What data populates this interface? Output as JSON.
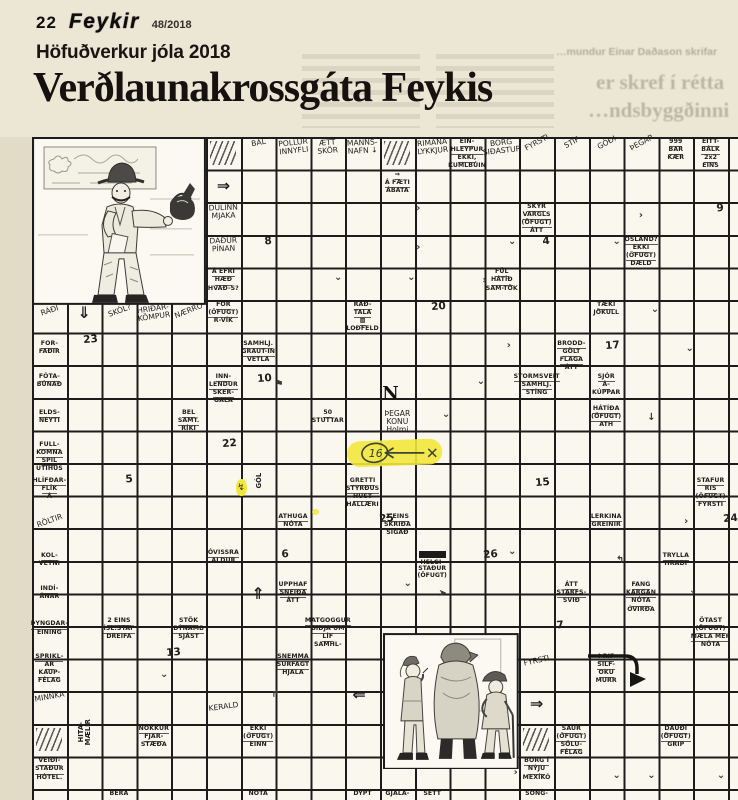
{
  "page": {
    "page_number": "22",
    "masthead": "Feykir",
    "issue": "48/2018",
    "kicker": "Höfuðverkur jóla 2018",
    "headline": "Verðlaunakrossgáta Feykis",
    "ghost": [
      "…mundur Einar Daðason skrifar",
      "er skref í rétta",
      "…ndsbyggðinni"
    ]
  },
  "colors": {
    "page_bg": "#e2dbc6",
    "header_bg": "#ece6d5",
    "paper": "#faf7ef",
    "grid_line": "#1c1c1c",
    "highlighter": "#f2e73c"
  },
  "grid": {
    "origin_x": 32,
    "origin_y": 137,
    "cell_w": 34.8,
    "cell_h": 32.6,
    "cols": 20,
    "rows": 20,
    "highlight": {
      "r": 10.2,
      "c": 10.0,
      "w": 2.85,
      "h": 1.0,
      "label": "16"
    },
    "illustrations": [
      {
        "id": "illus-man",
        "name": "man-with-kettle-drawing",
        "r": 1,
        "c": 1,
        "w": 5.0,
        "h": 5.15
      },
      {
        "id": "illus-figures",
        "name": "three-figures-drawing",
        "r": 16.2,
        "c": 11.1,
        "w": 3.9,
        "h": 4.2
      }
    ],
    "cells": [
      {
        "r": 1,
        "c": 6,
        "k": "hatch"
      },
      {
        "r": 1,
        "c": 7,
        "k": "script",
        "t": [
          "BÁL"
        ],
        "rot": -10
      },
      {
        "r": 1,
        "c": 8,
        "k": "script",
        "t": [
          "POLLUR",
          "INNYFLI"
        ],
        "rot": -6
      },
      {
        "r": 1,
        "c": 9,
        "k": "script",
        "t": [
          "ÆTT",
          "SKÖR"
        ],
        "rot": -4
      },
      {
        "r": 1,
        "c": 10,
        "k": "script",
        "t": [
          "MANNS-",
          "NAFN ↓"
        ],
        "rot": -3
      },
      {
        "r": 1,
        "c": 11,
        "k": "hatch"
      },
      {
        "r": 1,
        "c": 12,
        "k": "script",
        "t": [
          "RIMANA",
          "LYKKJUR"
        ],
        "rot": -5
      },
      {
        "r": 1,
        "c": 13,
        "k": "clue",
        "t": [
          "EIN-",
          "HLEYPUR",
          "EKKI,",
          "KUMLBÚIN"
        ]
      },
      {
        "r": 1,
        "c": 14,
        "k": "script",
        "t": [
          "BORG",
          "SIÐASTUR"
        ],
        "rot": -6
      },
      {
        "r": 1,
        "c": 15,
        "k": "script",
        "t": [
          "FYRSTI"
        ],
        "rot": -28
      },
      {
        "r": 1,
        "c": 16,
        "k": "script",
        "t": [
          "STÍF"
        ],
        "rot": -28
      },
      {
        "r": 1,
        "c": 17,
        "k": "script",
        "t": [
          "GÓÐI"
        ],
        "rot": -28
      },
      {
        "r": 1,
        "c": 18,
        "k": "script",
        "t": [
          "ÞEGAR"
        ],
        "rot": -28
      },
      {
        "r": 1,
        "c": 19,
        "k": "clue",
        "t": [
          "999",
          "BAR",
          "KÆR"
        ]
      },
      {
        "r": 1,
        "c": 20,
        "k": "clue",
        "t": [
          "EITT-",
          "BÁLK",
          "2x2",
          "EINS"
        ]
      },
      {
        "r": 2.2,
        "c": 6,
        "k": "bigarrow",
        "t": [
          "⇒"
        ]
      },
      {
        "r": 2,
        "c": 11,
        "k": "clue",
        "t": [
          "⇒",
          "Á FÆTI",
          "ÁBATA"
        ]
      },
      {
        "r": 3,
        "c": 6,
        "k": "script",
        "t": [
          "DULINN",
          "MJAKA"
        ],
        "rot": -2
      },
      {
        "r": 3,
        "c": 15,
        "k": "clue",
        "t": [
          "SKYR",
          "VARGLS",
          "(ÖFUGT)",
          "ÁTT"
        ]
      },
      {
        "r": 3,
        "c": 20,
        "k": "num",
        "t": [
          "9"
        ]
      },
      {
        "r": 4,
        "c": 6,
        "k": "script",
        "t": [
          "DAÐUR",
          "PÍNAN"
        ],
        "rot": -2
      },
      {
        "r": 4,
        "c": 7,
        "k": "num",
        "t": [
          "8"
        ]
      },
      {
        "r": 4,
        "c": 15,
        "k": "num",
        "t": [
          "4"
        ]
      },
      {
        "r": 4,
        "c": 18,
        "k": "clue",
        "t": [
          "ÓSLAND?",
          "EKKI",
          "(ÖFUGT)",
          "DÆLD"
        ]
      },
      {
        "r": 5,
        "c": 6,
        "k": "clue",
        "t": [
          "Á EFRI",
          "HÆÐ",
          "HVAÐ-S?"
        ]
      },
      {
        "r": 5,
        "c": 14,
        "k": "clue",
        "t": [
          "FÚL",
          "HÁTÍÐ",
          "SAM-TÖK"
        ]
      },
      {
        "r": 6.15,
        "c": 1,
        "k": "script",
        "t": [
          "RÁÐI"
        ],
        "rot": -18
      },
      {
        "r": 6.1,
        "c": 2,
        "k": "bigarrow",
        "t": [
          "⇓"
        ]
      },
      {
        "r": 6.15,
        "c": 3,
        "k": "script",
        "t": [
          "SKÓL?"
        ],
        "rot": -20
      },
      {
        "r": 6.1,
        "c": 4,
        "k": "script",
        "t": [
          "HRIÐAR-",
          "KÖMPUR"
        ],
        "rot": -8
      },
      {
        "r": 6.15,
        "c": 5,
        "k": "script",
        "t": [
          "NÆRRÓ"
        ],
        "rot": -22
      },
      {
        "r": 6,
        "c": 6,
        "k": "clue",
        "t": [
          "FOR",
          "(ÖFUGT)",
          "R-VÍK"
        ]
      },
      {
        "r": 6,
        "c": 10,
        "k": "clue",
        "t": [
          "RAÐ-",
          "TALA",
          "▩",
          "LOÐFELD"
        ]
      },
      {
        "r": 6,
        "c": 12,
        "k": "num",
        "t": [
          "20"
        ]
      },
      {
        "r": 6,
        "c": 17,
        "k": "clue",
        "t": [
          "TÆKI",
          "JÖKULL"
        ]
      },
      {
        "r": 7.2,
        "c": 1,
        "k": "clue",
        "t": [
          "FOR-",
          "FAÐIR"
        ]
      },
      {
        "r": 7,
        "c": 2,
        "k": "num",
        "t": [
          "23"
        ]
      },
      {
        "r": 7.2,
        "c": 7,
        "k": "clue",
        "t": [
          "SAMHLJ.",
          "GRAUT-IN",
          "VETLA"
        ]
      },
      {
        "r": 7.2,
        "c": 16,
        "k": "clue",
        "t": [
          "BRODD-",
          "GÖLT",
          "FLAGA",
          "ÁTT"
        ]
      },
      {
        "r": 7.2,
        "c": 17,
        "k": "num",
        "t": [
          "17"
        ]
      },
      {
        "r": 8.2,
        "c": 1,
        "k": "clue",
        "t": [
          "FÓTA-",
          "BÚNAÐ"
        ]
      },
      {
        "r": 8.2,
        "c": 6,
        "k": "clue",
        "t": [
          "INN-",
          "LENDUR",
          "SKER-",
          "GALA"
        ]
      },
      {
        "r": 8.2,
        "c": 7,
        "k": "num",
        "t": [
          "10"
        ]
      },
      {
        "r": 8.5,
        "c": 10.8,
        "k": "bigletter",
        "t": [
          "N"
        ]
      },
      {
        "r": 8.2,
        "c": 15,
        "k": "clue",
        "t": [
          "STORMSVEIT",
          "SAMHLJ.",
          "STÍNG"
        ]
      },
      {
        "r": 8.2,
        "c": 17,
        "k": "clue",
        "t": [
          "SJÓR",
          "Á-",
          "KÚPPAR"
        ]
      },
      {
        "r": 9.3,
        "c": 1,
        "k": "clue",
        "t": [
          "ELDS-",
          "NEYTI"
        ]
      },
      {
        "r": 9.3,
        "c": 5,
        "k": "clue",
        "t": [
          "BEL",
          "SAMT.",
          "RÍKI"
        ]
      },
      {
        "r": 9.3,
        "c": 9,
        "k": "clue",
        "t": [
          "50",
          "STUTTAR"
        ]
      },
      {
        "r": 9.3,
        "c": 11,
        "k": "script",
        "t": [
          "ÞEGAR",
          "KONU",
          "Holmi"
        ]
      },
      {
        "r": 9.2,
        "c": 17,
        "k": "clue",
        "t": [
          "HÁTÍÐA",
          "(ÖFUGT)",
          "ATH"
        ]
      },
      {
        "r": 10.3,
        "c": 1,
        "k": "clue",
        "t": [
          "FULL-",
          "KOMNA",
          "SPIL",
          "ÚTIHÚS"
        ]
      },
      {
        "r": 10.2,
        "c": 6,
        "k": "num",
        "t": [
          "22"
        ]
      },
      {
        "r": 11.4,
        "c": 1,
        "k": "clue",
        "t": [
          "HLÍFÐAR-",
          "FLÍK",
          "Á"
        ]
      },
      {
        "r": 11.3,
        "c": 3,
        "k": "num",
        "t": [
          "5"
        ]
      },
      {
        "r": 11.5,
        "c": 6.85,
        "k": "flame",
        "t": [
          "↯"
        ]
      },
      {
        "r": 11.4,
        "c": 7,
        "k": "vert",
        "t": [
          "GÓL"
        ]
      },
      {
        "r": 11.4,
        "c": 10,
        "k": "clue",
        "t": [
          "GRETTI",
          "STYRÐUS",
          "HUST",
          "HALLÆRI"
        ]
      },
      {
        "r": 11.4,
        "c": 15,
        "k": "num",
        "t": [
          "15"
        ]
      },
      {
        "r": 11.4,
        "c": 20,
        "k": "clue",
        "t": [
          "STAFUR",
          "RIS",
          "(ÖFUGT)",
          "FYRSTI"
        ]
      },
      {
        "r": 12.6,
        "c": 1,
        "k": "script",
        "t": [
          "RÖLTIR"
        ],
        "rot": -20
      },
      {
        "r": 12.5,
        "c": 8,
        "k": "clue",
        "t": [
          "ATHUGA",
          "NÓTA"
        ]
      },
      {
        "r": 12.4,
        "c": 9.05,
        "k": "dot"
      },
      {
        "r": 12.5,
        "c": 10.5,
        "k": "num",
        "t": [
          "25"
        ]
      },
      {
        "r": 12.5,
        "c": 11,
        "k": "clue",
        "t": [
          "2 EINS",
          "SKRIÐA",
          "SIGAÐ"
        ]
      },
      {
        "r": 12.5,
        "c": 17,
        "k": "clue",
        "t": [
          "LERKINA",
          "GREINIR"
        ]
      },
      {
        "r": 12.5,
        "c": 20.4,
        "k": "num",
        "t": [
          "24"
        ]
      },
      {
        "r": 13.7,
        "c": 1,
        "k": "clue",
        "t": [
          "KOL-",
          "VETNI"
        ]
      },
      {
        "r": 13.6,
        "c": 6,
        "k": "clue",
        "t": [
          "ÓVISSRA",
          "ALDUR"
        ]
      },
      {
        "r": 13.6,
        "c": 7.5,
        "k": "num",
        "t": [
          "6"
        ]
      },
      {
        "r": 13.6,
        "c": 12,
        "k": "redacted",
        "t": [
          "HELGI-",
          "STAÐUR",
          "(ÖFUGT)"
        ]
      },
      {
        "r": 13.6,
        "c": 13.5,
        "k": "num",
        "t": [
          "26"
        ]
      },
      {
        "r": 13.7,
        "c": 19,
        "k": "clue",
        "t": [
          "TRYLLA",
          "HRAÐI"
        ]
      },
      {
        "r": 14.7,
        "c": 1,
        "k": "clue",
        "t": [
          "INDÍ-",
          "ÁNAR"
        ]
      },
      {
        "r": 14.7,
        "c": 7,
        "k": "bigarrow",
        "t": [
          "⇑"
        ]
      },
      {
        "r": 14.6,
        "c": 8,
        "k": "clue",
        "t": [
          "UPPHAF",
          "SNEIÐA",
          "ÁTT"
        ]
      },
      {
        "r": 14.6,
        "c": 16,
        "k": "clue",
        "t": [
          "ÁTT",
          "STARFS-",
          "SVIÐ"
        ]
      },
      {
        "r": 14.6,
        "c": 18,
        "k": "clue",
        "t": [
          "FANG",
          "KARGAN",
          "NÓTA",
          "ÓVIRÐA"
        ]
      },
      {
        "r": 15.8,
        "c": 1,
        "k": "clue",
        "t": [
          "ÞYNGDAR-",
          "EINING"
        ]
      },
      {
        "r": 15.7,
        "c": 3,
        "k": "clue",
        "t": [
          "2 EINS",
          "ÍSL.STAF",
          "DREIFA"
        ]
      },
      {
        "r": 15.7,
        "c": 5,
        "k": "clue",
        "t": [
          "STÖK",
          "DÝNAMB",
          "SJÁST"
        ]
      },
      {
        "r": 15.7,
        "c": 9,
        "k": "clue",
        "t": [
          "MATGOGGUR",
          "BIÐJA UM",
          "LÍF",
          "SAMHL-"
        ]
      },
      {
        "r": 15.8,
        "c": 15.4,
        "k": "num",
        "t": [
          "7"
        ]
      },
      {
        "r": 15.7,
        "c": 20,
        "k": "clue",
        "t": [
          "ÖTAST",
          "(ÖFUGT)",
          "MÆLA MER",
          "NÓTA"
        ]
      },
      {
        "r": 16.8,
        "c": 1,
        "k": "clue",
        "t": [
          "SPRIKL-",
          "AR",
          "KAUP-",
          "FÉLAG"
        ]
      },
      {
        "r": 16.6,
        "c": 4.4,
        "k": "num",
        "t": [
          "13"
        ]
      },
      {
        "r": 16.8,
        "c": 8,
        "k": "clue",
        "t": [
          "SNEMMA",
          "SURFAGT",
          "HJALA"
        ]
      },
      {
        "r": 16.9,
        "c": 15,
        "k": "script",
        "t": [
          "FYRSTI"
        ],
        "rot": -12
      },
      {
        "r": 16.8,
        "c": 17,
        "k": "clue",
        "t": [
          "ÞRIF",
          "SILF-",
          "OKU",
          "MURR"
        ]
      },
      {
        "r": 18,
        "c": 1,
        "k": "script",
        "t": [
          "MINNKA"
        ],
        "rot": -10
      },
      {
        "r": 17.8,
        "c": 9.9,
        "k": "bigarrow",
        "t": [
          "⇐"
        ]
      },
      {
        "r": 18.1,
        "c": 15,
        "k": "bigarrow",
        "t": [
          "⇒"
        ]
      },
      {
        "r": 18.3,
        "c": 6,
        "k": "script",
        "t": [
          "KERALD"
        ],
        "rot": -8
      },
      {
        "r": 19,
        "c": 1,
        "k": "hatch"
      },
      {
        "r": 19,
        "c": 2,
        "k": "vert",
        "t": [
          "HITA-",
          "MÆLIR"
        ]
      },
      {
        "r": 19,
        "c": 4,
        "k": "clue",
        "t": [
          "NOKKUR",
          "FJAR-",
          "STÆÐA"
        ]
      },
      {
        "r": 19,
        "c": 7,
        "k": "clue",
        "t": [
          "EKKI",
          "(ÖFUGT)",
          "EINN"
        ]
      },
      {
        "r": 19,
        "c": 15,
        "k": "hatch"
      },
      {
        "r": 19,
        "c": 16,
        "k": "clue",
        "t": [
          "SAUR",
          "(ÖFUGT)",
          "SÖLU-",
          "FÉLAG"
        ]
      },
      {
        "r": 19,
        "c": 19,
        "k": "clue",
        "t": [
          "DAUÐI",
          "(ÖFUGT)",
          "GRIP"
        ]
      },
      {
        "r": 20,
        "c": 1,
        "k": "clue",
        "t": [
          "VEIÐI-",
          "STAÐUR",
          "HÓTEL."
        ]
      },
      {
        "r": 20,
        "c": 15,
        "k": "clue",
        "t": [
          "BORG Í",
          "NÝJU",
          "MEXÍKÓ"
        ]
      },
      {
        "r": 21,
        "c": 3,
        "k": "clue",
        "t": [
          "BERA"
        ]
      },
      {
        "r": 21,
        "c": 7,
        "k": "clue",
        "t": [
          "NÓTA"
        ]
      },
      {
        "r": 21,
        "c": 10,
        "k": "clue",
        "t": [
          "DÝPT"
        ]
      },
      {
        "r": 21,
        "c": 11,
        "k": "clue",
        "t": [
          "GJALA-"
        ]
      },
      {
        "r": 21,
        "c": 12,
        "k": "clue",
        "t": [
          "SETT"
        ]
      },
      {
        "r": 21,
        "c": 15,
        "k": "clue",
        "t": [
          "SÖNG-"
        ]
      },
      {
        "r": 3,
        "c": 11.6,
        "k": "mark",
        "t": [
          "›"
        ]
      },
      {
        "r": 3.2,
        "c": 18,
        "k": "mark",
        "t": [
          "›"
        ]
      },
      {
        "r": 4.2,
        "c": 11.6,
        "k": "mark",
        "t": [
          "›"
        ]
      },
      {
        "r": 4,
        "c": 14.3,
        "k": "mark",
        "t": [
          "⌄"
        ]
      },
      {
        "r": 4,
        "c": 17.3,
        "k": "mark",
        "t": [
          "⌄"
        ]
      },
      {
        "r": 5.1,
        "c": 9.3,
        "k": "mark",
        "t": [
          "⌄"
        ]
      },
      {
        "r": 5.1,
        "c": 11.4,
        "k": "mark",
        "t": [
          "⌄"
        ]
      },
      {
        "r": 5.2,
        "c": 13.5,
        "k": "mark",
        "t": [
          "›"
        ]
      },
      {
        "r": 6.1,
        "c": 18.4,
        "k": "mark",
        "t": [
          "⌄"
        ]
      },
      {
        "r": 7.2,
        "c": 14.2,
        "k": "mark",
        "t": [
          "›"
        ]
      },
      {
        "r": 7.3,
        "c": 19.4,
        "k": "mark",
        "t": [
          "⌄"
        ]
      },
      {
        "r": 8.3,
        "c": 13.4,
        "k": "mark",
        "t": [
          "⌄"
        ]
      },
      {
        "r": 8.4,
        "c": 7.6,
        "k": "mark",
        "t": [
          "⚑"
        ]
      },
      {
        "r": 9.3,
        "c": 12.4,
        "k": "mark",
        "t": [
          "⌄"
        ]
      },
      {
        "r": 9.4,
        "c": 18.3,
        "k": "mark",
        "t": [
          "↓"
        ]
      },
      {
        "r": 12.6,
        "c": 19.3,
        "k": "mark",
        "t": [
          "›"
        ]
      },
      {
        "r": 13.5,
        "c": 14.3,
        "k": "mark",
        "t": [
          "⌄"
        ]
      },
      {
        "r": 13.8,
        "c": 17.4,
        "k": "mark",
        "t": [
          "↰"
        ]
      },
      {
        "r": 14.8,
        "c": 12.3,
        "k": "mark",
        "t": [
          "➤"
        ]
      },
      {
        "r": 14.5,
        "c": 11.3,
        "k": "mark",
        "t": [
          "⌄"
        ]
      },
      {
        "r": 14.7,
        "c": 19.5,
        "k": "mark",
        "t": [
          "⌄"
        ]
      },
      {
        "r": 17.3,
        "c": 4.3,
        "k": "mark",
        "t": [
          "⌄"
        ]
      },
      {
        "r": 17.9,
        "c": 7.5,
        "k": "mark",
        "t": [
          "↱"
        ]
      },
      {
        "r": 19.6,
        "c": 13.5,
        "k": "mark",
        "t": [
          "›"
        ]
      },
      {
        "r": 20.3,
        "c": 14.4,
        "k": "mark",
        "t": [
          "›"
        ]
      },
      {
        "r": 20.4,
        "c": 17.3,
        "k": "mark",
        "t": [
          "⌄"
        ]
      },
      {
        "r": 20.4,
        "c": 18.3,
        "k": "mark",
        "t": [
          "⌄"
        ]
      },
      {
        "r": 20.4,
        "c": 20.3,
        "k": "mark",
        "t": [
          "⌄"
        ]
      }
    ]
  }
}
